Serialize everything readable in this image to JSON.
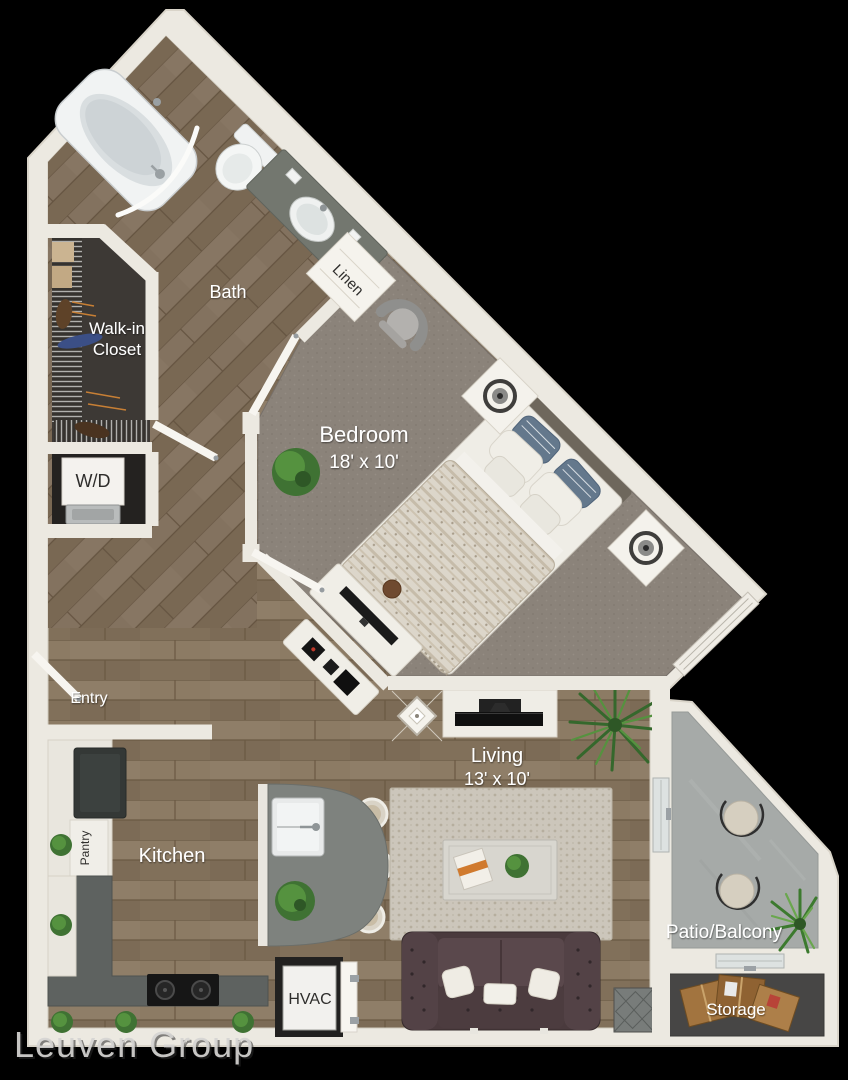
{
  "rooms": {
    "bath": {
      "label": "Bath"
    },
    "linen": {
      "label": "Linen"
    },
    "walk_in_closet": {
      "line1": "Walk-in",
      "line2": "Closet"
    },
    "laundry": {
      "label": "W/D"
    },
    "bedroom": {
      "label": "Bedroom",
      "dims": "18' x 10'"
    },
    "entry": {
      "label": "Entry"
    },
    "pantry": {
      "label": "Pantry"
    },
    "kitchen": {
      "label": "Kitchen"
    },
    "living": {
      "label": "Living",
      "dims": "13' x 10'"
    },
    "hvac": {
      "label": "HVAC"
    },
    "patio": {
      "label": "Patio/Balcony"
    },
    "storage": {
      "label": "Storage"
    }
  },
  "watermark": {
    "text": "Leuven Group"
  },
  "colors": {
    "background": "#000000",
    "wall": "#ece9e1",
    "wood_floor": "#877660",
    "bedroom_carpet": "#8b837a",
    "closet_floor": "#3d3935",
    "patio_concrete": "#a6aaa8",
    "storage_floor": "#474645",
    "sofa": "#4a3a3d",
    "island": "#7e827e",
    "plant_green": "#4c8040",
    "label_light": "#ffffff",
    "label_dark": "#2e2d2b"
  }
}
